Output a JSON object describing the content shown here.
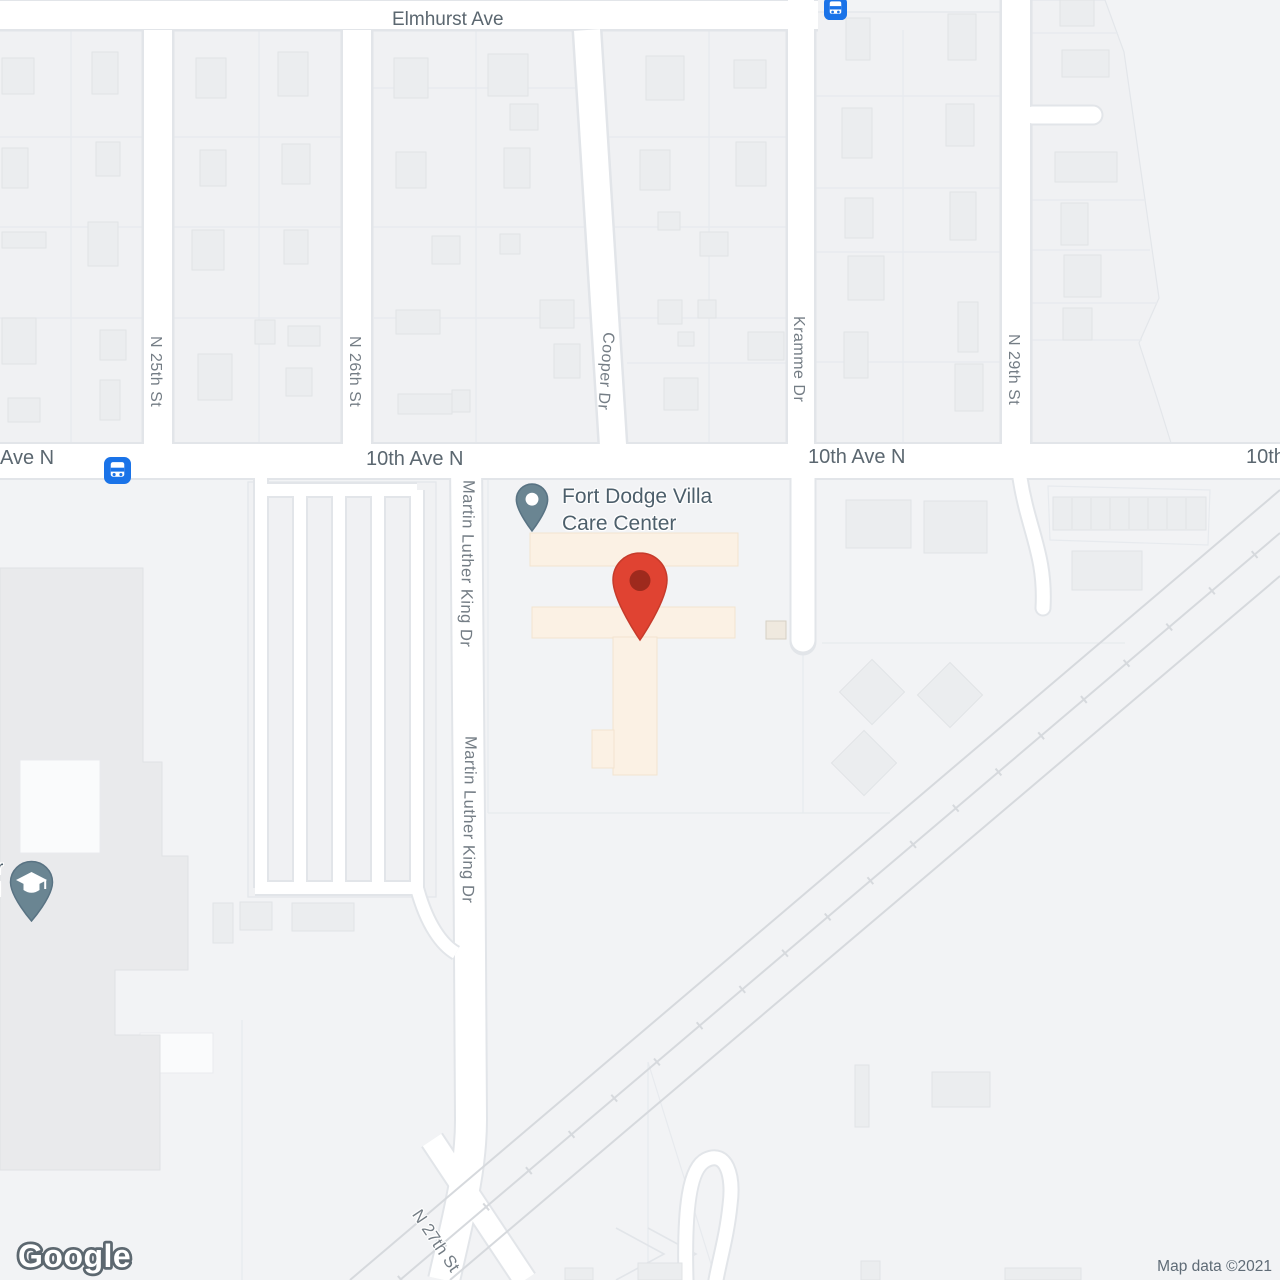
{
  "map": {
    "poi": {
      "name_line1": "Fort Dodge Villa",
      "name_line2": "Care Center"
    },
    "street_labels": {
      "elmhurst_ave": "Elmhurst Ave",
      "n_25th_st": "N 25th St",
      "n_26th_st": "N 26th St",
      "cooper_dr": "Cooper Dr",
      "kramme_dr": "Kramme Dr",
      "n_29th_st": "N 29th St",
      "tenth_ave_n_left_partial": "Ave N",
      "tenth_ave_n_west": "10th Ave N",
      "tenth_ave_n_east": "10th Ave N",
      "tenth_ave_n_right_edge": "10th Ave N",
      "mlk_dr_north": "Martin Luther King Dr",
      "mlk_dr_south": "Martin Luther King Dr",
      "n_27th_st": "N 27th St"
    },
    "school_label_fragments": {
      "line1": "r",
      "line2": "l"
    },
    "attribution": {
      "logo_text": "Google",
      "copyright": "Map data ©2021"
    },
    "icons": {
      "bus_stop_top": "bus-stop-icon",
      "bus_stop_10th_ave": "bus-stop-icon",
      "school_pin": "school-pin-icon",
      "poi_pin": "place-pin-icon",
      "red_marker": "red-location-marker"
    },
    "colors": {
      "land": "#f2f3f5",
      "block": "#f0f1f3",
      "road_fill": "#ffffff",
      "road_casing": "#e2e5e9",
      "building_fill": "#ebedef",
      "building_stroke": "#e0e3e6",
      "campus_fill": "#e9eaec",
      "poi_building_fill": "#fbf1e4",
      "rail": "#d6d9dd",
      "label_minor": "#747d85",
      "label_major": "#5b6770",
      "poi_label": "#4d5f6b",
      "pin_slate": "#6a8592",
      "pin_slate_dark": "#597383",
      "marker_red": "#e04332",
      "marker_red_dark": "#9e2a1d",
      "transit_blue": "#1a73e8",
      "attribution_text": "#5f6b76"
    }
  }
}
